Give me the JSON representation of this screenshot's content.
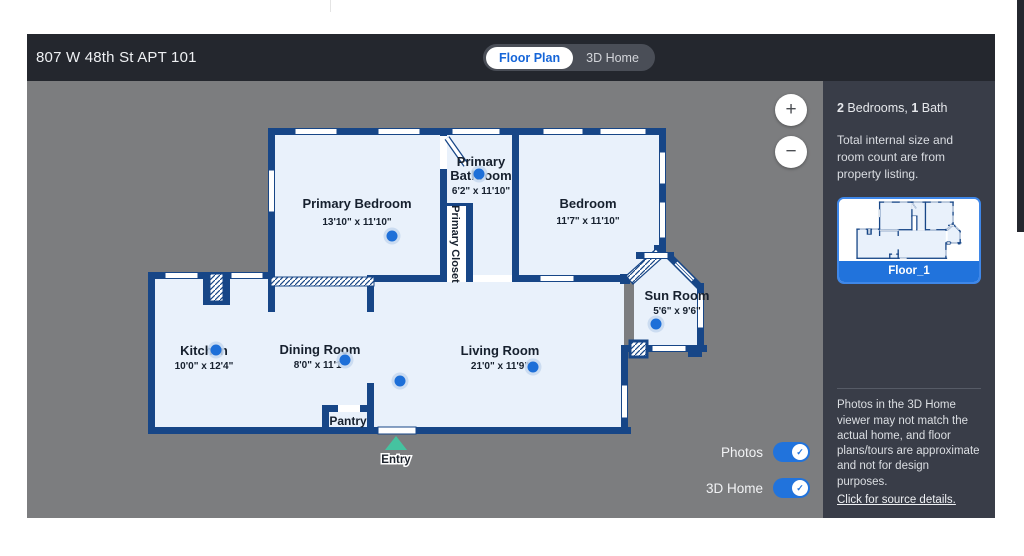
{
  "window": {
    "address": "807 W 48th St APT 101"
  },
  "tabs": {
    "floor_plan": "Floor Plan",
    "three_d_home": "3D Home"
  },
  "zoom_controls": {
    "zoom_in": "+",
    "zoom_out": "−"
  },
  "toggles": {
    "photos_label": "Photos",
    "home3d_label": "3D Home",
    "photos_on": true,
    "home3d_on": true,
    "check": "✓"
  },
  "sidebar": {
    "summary": {
      "beds_count": "2",
      "beds_text": " Bedrooms, ",
      "baths_count": "1",
      "baths_text": " Bath"
    },
    "note": "Total internal size and room count are from property listing.",
    "thumbnail_label": "Floor_1",
    "disclaimer": "Photos in the 3D Home viewer may not match the actual home, and floor plans/tours are approximate and not for design purposes.",
    "source_link": "Click for source details."
  },
  "floorplan": {
    "entry_label": "Entry",
    "rooms": [
      {
        "name": "Primary Bedroom",
        "dims": "13'10\" x 11'10\""
      },
      {
        "name_lines": [
          "Primary",
          "Bathroom"
        ],
        "dims": "6'2\" x 11'10\""
      },
      {
        "name": "Primary Closet"
      },
      {
        "name": "Bedroom",
        "dims": "11'7\" x 11'10\""
      },
      {
        "name": "Sun Room",
        "dims": "5'6\" x 9'6\""
      },
      {
        "name": "Kitchen",
        "dims": "10'0\" x 12'4\""
      },
      {
        "name": "Dining Room",
        "dims": "8'0\" x 11'1\""
      },
      {
        "name": "Living Room",
        "dims": "21'0\" x 11'9\""
      },
      {
        "name": "Pantry"
      }
    ]
  },
  "colors": {
    "wall": "#174687",
    "room_fill": "#e9f1fb",
    "accent_blue": "#2173dc",
    "entry_teal": "#45c3a0",
    "header_bg": "#24272e",
    "canvas_bg": "#7c7d7f",
    "sidebar_bg": "#393d48"
  }
}
